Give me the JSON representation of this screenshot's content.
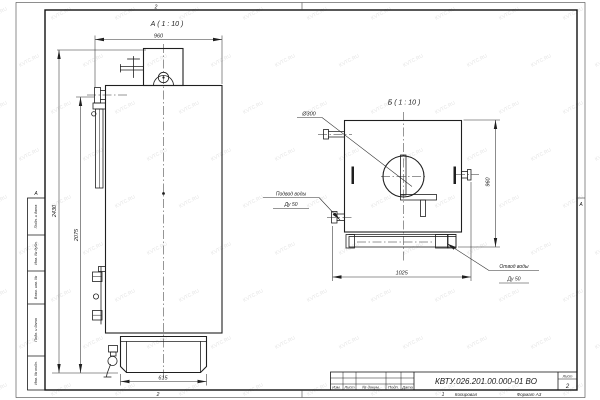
{
  "watermark": "KVTC.RU",
  "frame": {
    "zone_top": "2",
    "zone_bottom": "2",
    "zone_bottom_right": "1",
    "zone_letter_left": "А",
    "zone_letter_right": "А",
    "stamp_columns": [
      "Подп. и дата",
      "Инв. № дубл.",
      "Взам. инв. №",
      "Подп. и дата",
      "Инв. № подл."
    ]
  },
  "title_block": {
    "doc_number": "КВТУ.026.201.00.000-01 ВО",
    "col_izm": "Изм.",
    "col_list": "Лист",
    "col_doc": "№ докум.",
    "col_podp": "Подп.",
    "col_data": "Дата",
    "sheet_label": "Лист",
    "sheet_number": "2",
    "copied": "Копировал",
    "format": "Формат А3"
  },
  "view_a": {
    "label": "А ( 1 : 10 )",
    "dim_width": "960",
    "dim_height_total": "2430",
    "dim_height_body": "2075",
    "dim_base": "615"
  },
  "view_b": {
    "label": "Б ( 1 : 10 )",
    "dim_diameter": "Ø300",
    "dim_width": "1025",
    "dim_height": "960",
    "note_inlet_1": "Подвод воды",
    "note_inlet_2": "Ду 50",
    "note_outlet_1": "Отвод воды",
    "note_outlet_2": "Ду 50"
  }
}
